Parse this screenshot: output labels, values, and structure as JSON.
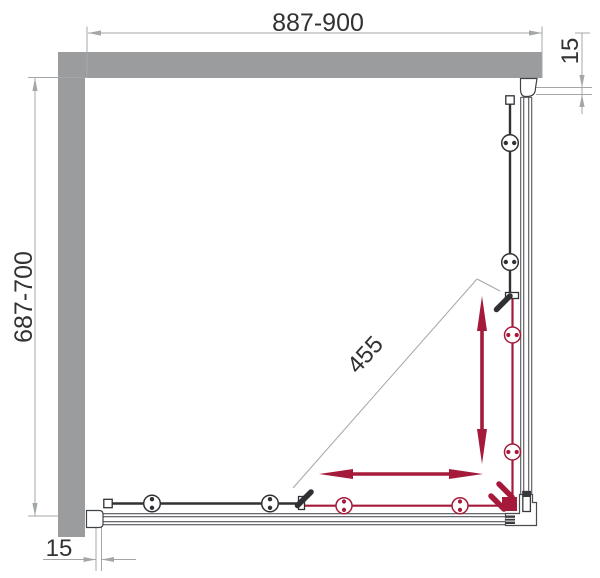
{
  "drawing": {
    "type": "shower-enclosure-plan-view",
    "dimensions": {
      "width": "887-900",
      "depth": "687-700",
      "diagonal_opening": "455",
      "wall_profile_adjust_top": "15",
      "wall_profile_adjust_bottom": "15"
    },
    "colors": {
      "wall_gray": "#9b9c9e",
      "dimension_line_gray": "#a4a7aa",
      "frame_gray": "#54565a",
      "panel_dark": "#303134",
      "accent_red": "#a51a3a"
    }
  }
}
